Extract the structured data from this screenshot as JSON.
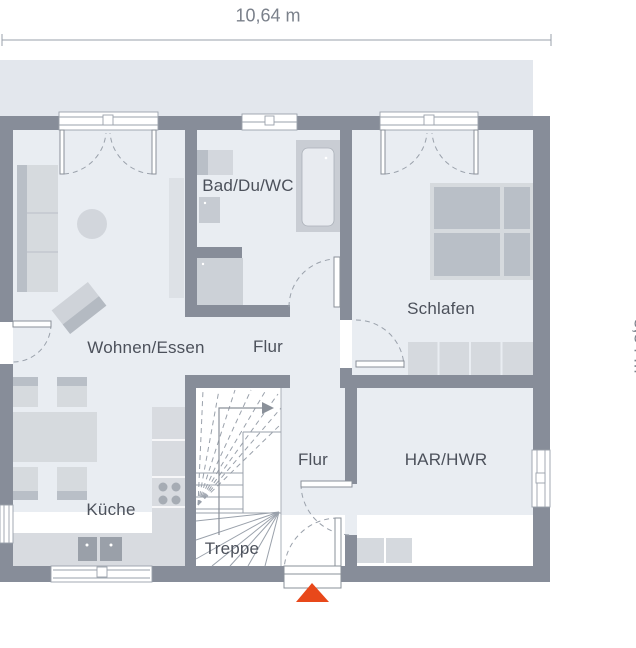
{
  "dimensions": {
    "width_label": "10,64 m",
    "depth_label": "8,84 m"
  },
  "rooms": [
    {
      "id": "wohnen-essen",
      "label": "Wohnen/Essen"
    },
    {
      "id": "flur-upper",
      "label": "Flur"
    },
    {
      "id": "bad-du-wc",
      "label": "Bad/Du/WC"
    },
    {
      "id": "schlafen",
      "label": "Schlafen"
    },
    {
      "id": "har-hwr",
      "label": "HAR/HWR"
    },
    {
      "id": "flur-lower",
      "label": "Flur"
    },
    {
      "id": "kueche",
      "label": "Küche"
    },
    {
      "id": "treppe",
      "label": "Treppe"
    }
  ],
  "icons": {
    "entrance_marker": "triangle-up",
    "stair_direction_arrow": "arrow-right"
  },
  "colors": {
    "wall": "#878d99",
    "floor": "#e9edf2",
    "roof_band": "#e3e7ed",
    "furniture_light": "#d6dade",
    "furniture_medium": "#b9bfc7",
    "appliance_dark": "#9aa0a9",
    "line": "#9aa1ab",
    "entrance_accent": "#e8481a",
    "room_label_text": "#4c515b",
    "dimension_text": "#7b818b"
  }
}
